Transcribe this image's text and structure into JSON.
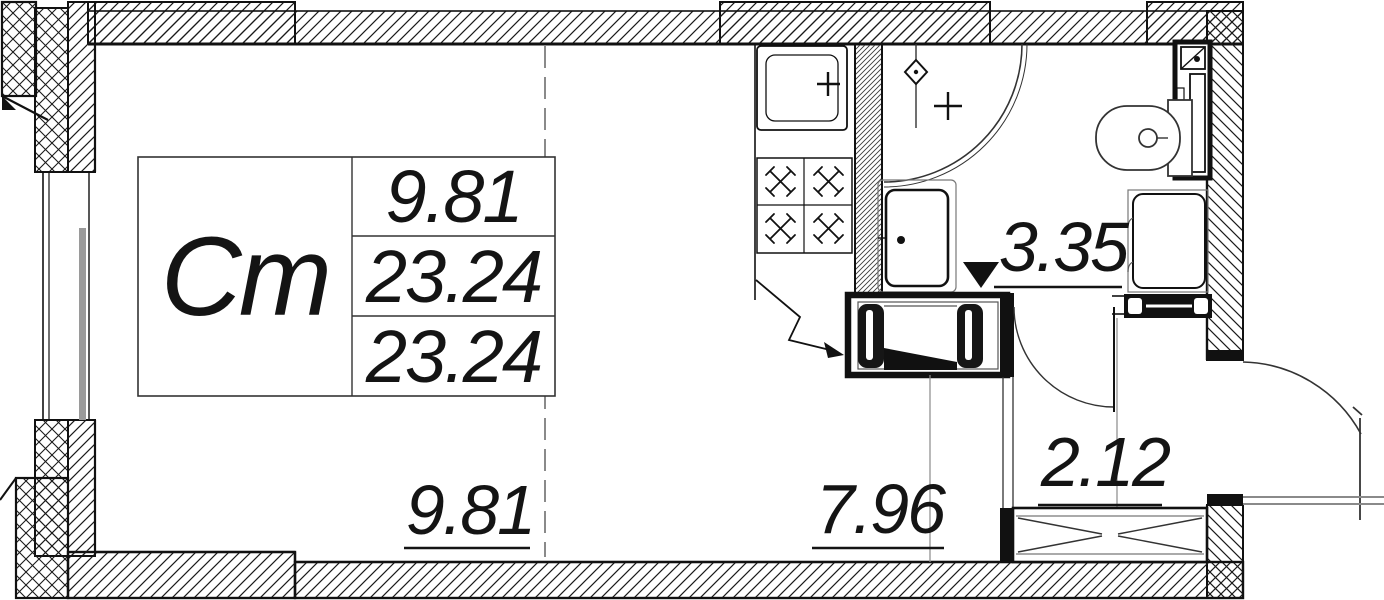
{
  "floorplan": {
    "unit_type_label": "Ст",
    "area_table": {
      "living_area": "9.81",
      "total_area": "23.24",
      "total_area_final": "23.24"
    },
    "room_labels": {
      "living_zone": "9.81",
      "kitchen_zone": "7.96",
      "bathroom": "3.35",
      "hallway": "2.12"
    }
  },
  "colors": {
    "ink": "#141414",
    "gray": "#8a8a8a",
    "background": "#ffffff"
  }
}
